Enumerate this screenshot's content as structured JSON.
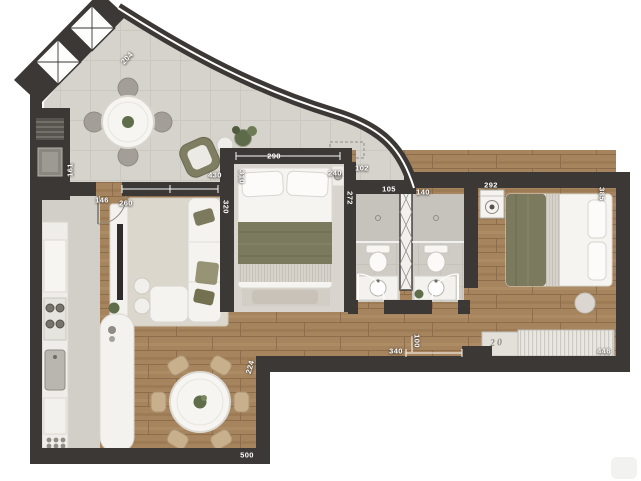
{
  "plan": {
    "kind": "apartment floor plan, top-down 3D render",
    "unit_hint": "cm"
  },
  "dimensions": {
    "d204": "204",
    "d161": "161",
    "d146": "146",
    "d260": "260",
    "d430": "430",
    "d310": "310",
    "d320": "320",
    "d290": "290",
    "d240": "240",
    "d102": "102",
    "d272": "272",
    "d105": "105",
    "d140": "140",
    "d292": "292",
    "d385": "385",
    "d224": "224",
    "d500": "500",
    "d340": "340",
    "d100": "100",
    "d446": "446"
  },
  "decor": {
    "sideboard_print": "20"
  },
  "colors": {
    "wall": "#3b3835",
    "wood": "#a6855e",
    "tile": "#d6d3cd",
    "bath_tile": "#cfccc6",
    "accent_olive": "#7c7a5e",
    "furniture_white": "#f4f3ef"
  }
}
